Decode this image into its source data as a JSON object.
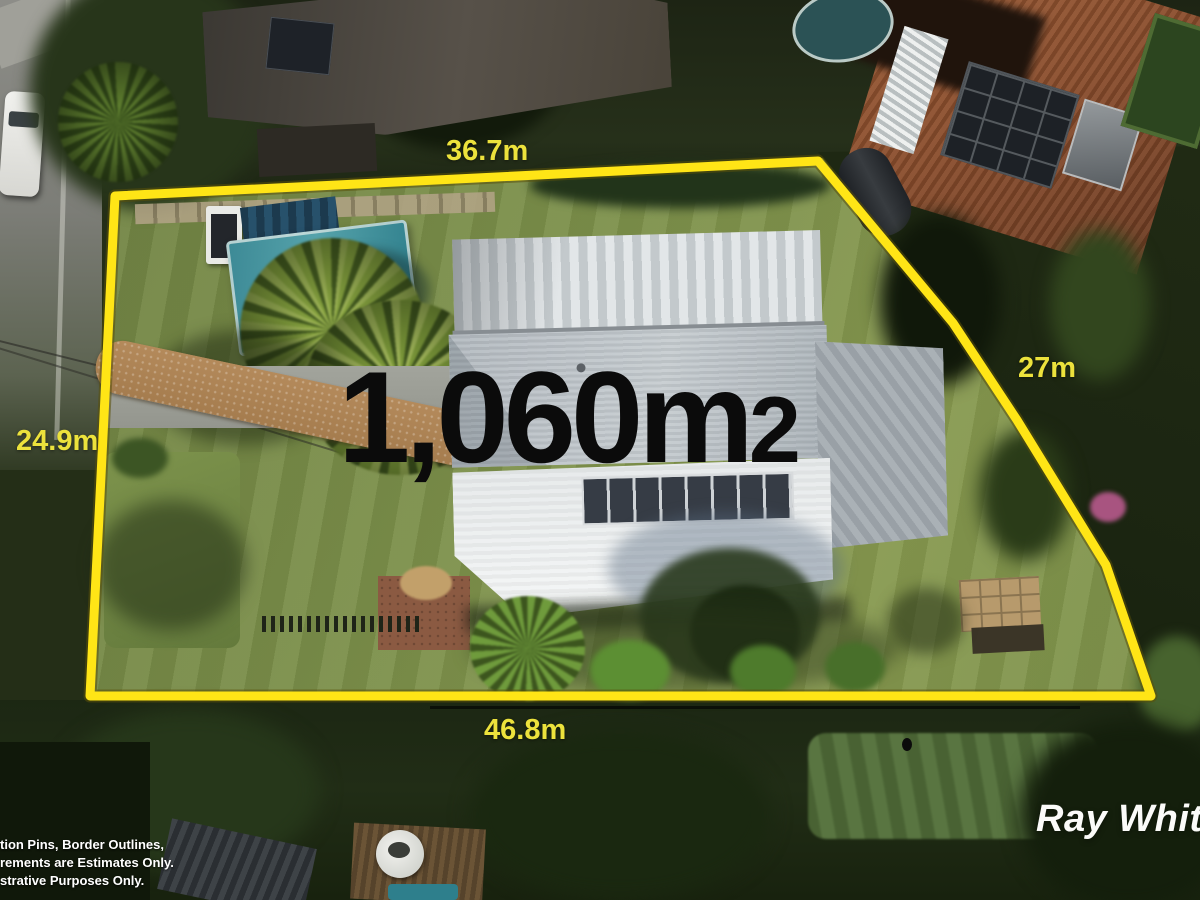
{
  "image": {
    "kind": "aerial-property-photo",
    "width_px": 1200,
    "height_px": 900
  },
  "overlay": {
    "area": {
      "value": "1,060m",
      "exponent": "2",
      "full_text": "1,060m2"
    },
    "dimensions": {
      "top": "36.7m",
      "right": "27m",
      "left": "24.9m",
      "bottom": "46.8m"
    },
    "colors": {
      "boundary_line": "#ffe516",
      "dimension_labels": "#ece23c",
      "area_text": "#0b0b0b"
    }
  },
  "watermark": {
    "text": "Ray White",
    "color": "#fbfbf9"
  },
  "disclaimer": {
    "lines": [
      "tion Pins, Border Outlines,",
      "rements are Estimates Only.",
      "strative Purposes Only."
    ]
  }
}
